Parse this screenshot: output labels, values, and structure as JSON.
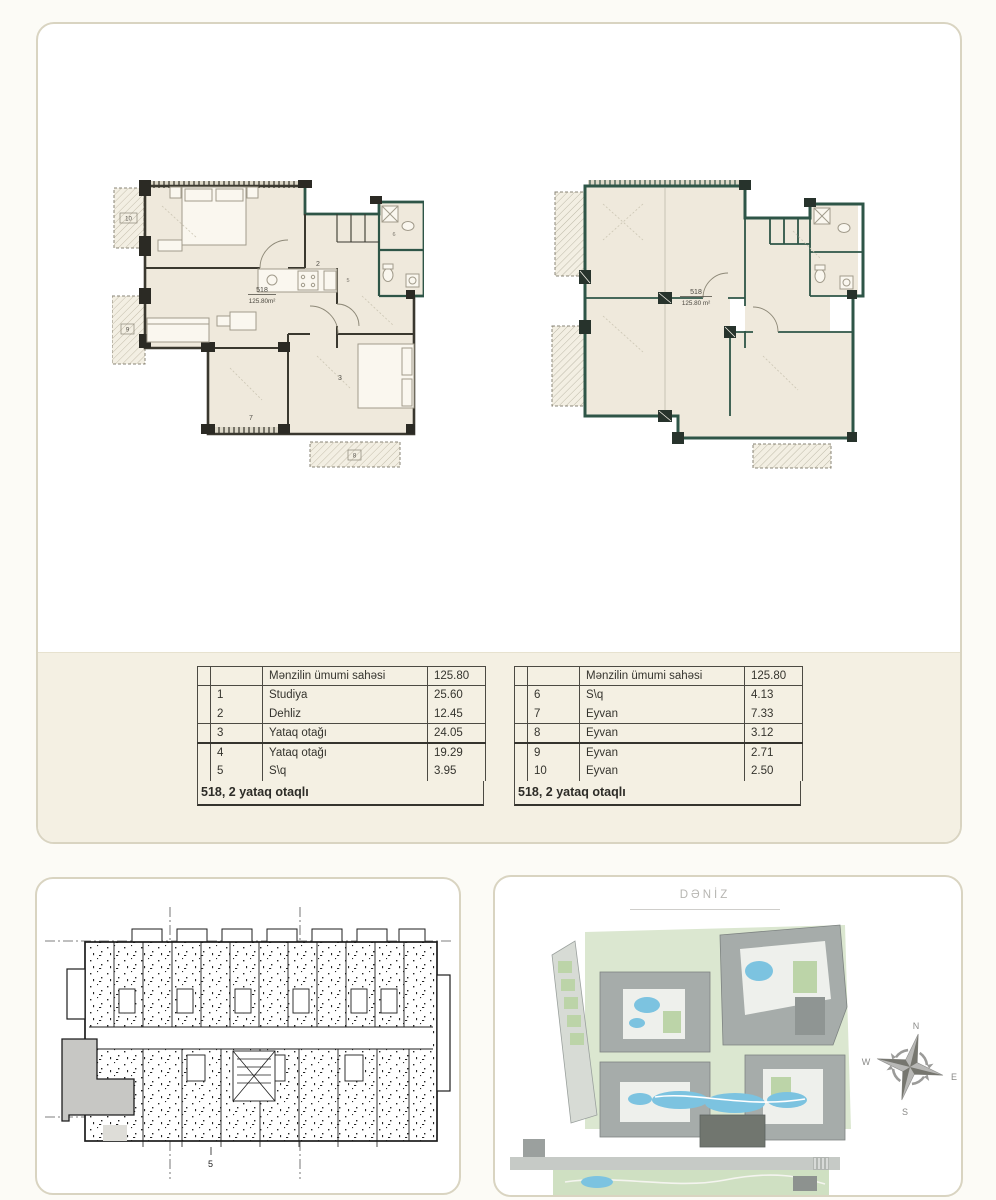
{
  "unit_card": {
    "left_plan": {
      "unit_number": "518",
      "area_label": "125.80m²",
      "rooms": {
        "r2": "2",
        "r3": "3",
        "r5": "5",
        "r6": "6",
        "r7": "7",
        "r8": "8",
        "r9": "9",
        "r10": "10"
      }
    },
    "right_plan": {
      "unit_number": "518",
      "area_label": "125.80 m²"
    }
  },
  "tables": {
    "left": {
      "header_label": "Mənzilin ümumi sahəsi",
      "header_value": "125.80",
      "rows": [
        {
          "num": "1",
          "name": "Studiya",
          "value": "25.60"
        },
        {
          "num": "2",
          "name": "Dehliz",
          "value": "12.45"
        },
        {
          "num": "3",
          "name": "Yataq otağı",
          "value": "24.05"
        },
        {
          "num": "4",
          "name": "Yataq otağı",
          "value": "19.29"
        },
        {
          "num": "5",
          "name": "S\\q",
          "value": "3.95"
        }
      ],
      "footer": "518, 2 yataq otaqlı"
    },
    "right": {
      "header_label": "Mənzilin ümumi sahəsi",
      "header_value": "125.80",
      "rows": [
        {
          "num": "6",
          "name": "S\\q",
          "value": "4.13"
        },
        {
          "num": "7",
          "name": "Eyvan",
          "value": "7.33"
        },
        {
          "num": "8",
          "name": "Eyvan",
          "value": "3.12"
        },
        {
          "num": "9",
          "name": "Eyvan",
          "value": "2.71"
        },
        {
          "num": "10",
          "name": "Eyvan",
          "value": "2.50"
        }
      ],
      "footer": "518, 2 yataq otaqlı"
    }
  },
  "floor_card": {
    "axis_label": "5"
  },
  "site_card": {
    "title": "DƏNİZ",
    "compass": {
      "n": "N",
      "e": "E",
      "s": "S",
      "w": "W"
    }
  },
  "colors": {
    "wall_teal": "#2e5547",
    "plan_cream": "#efe9dc",
    "band_beige": "#f4f0e3",
    "highlight_gray": "#c7c7c4",
    "pool_blue": "#7cc3e0",
    "building_gray": "#a6acaa"
  }
}
